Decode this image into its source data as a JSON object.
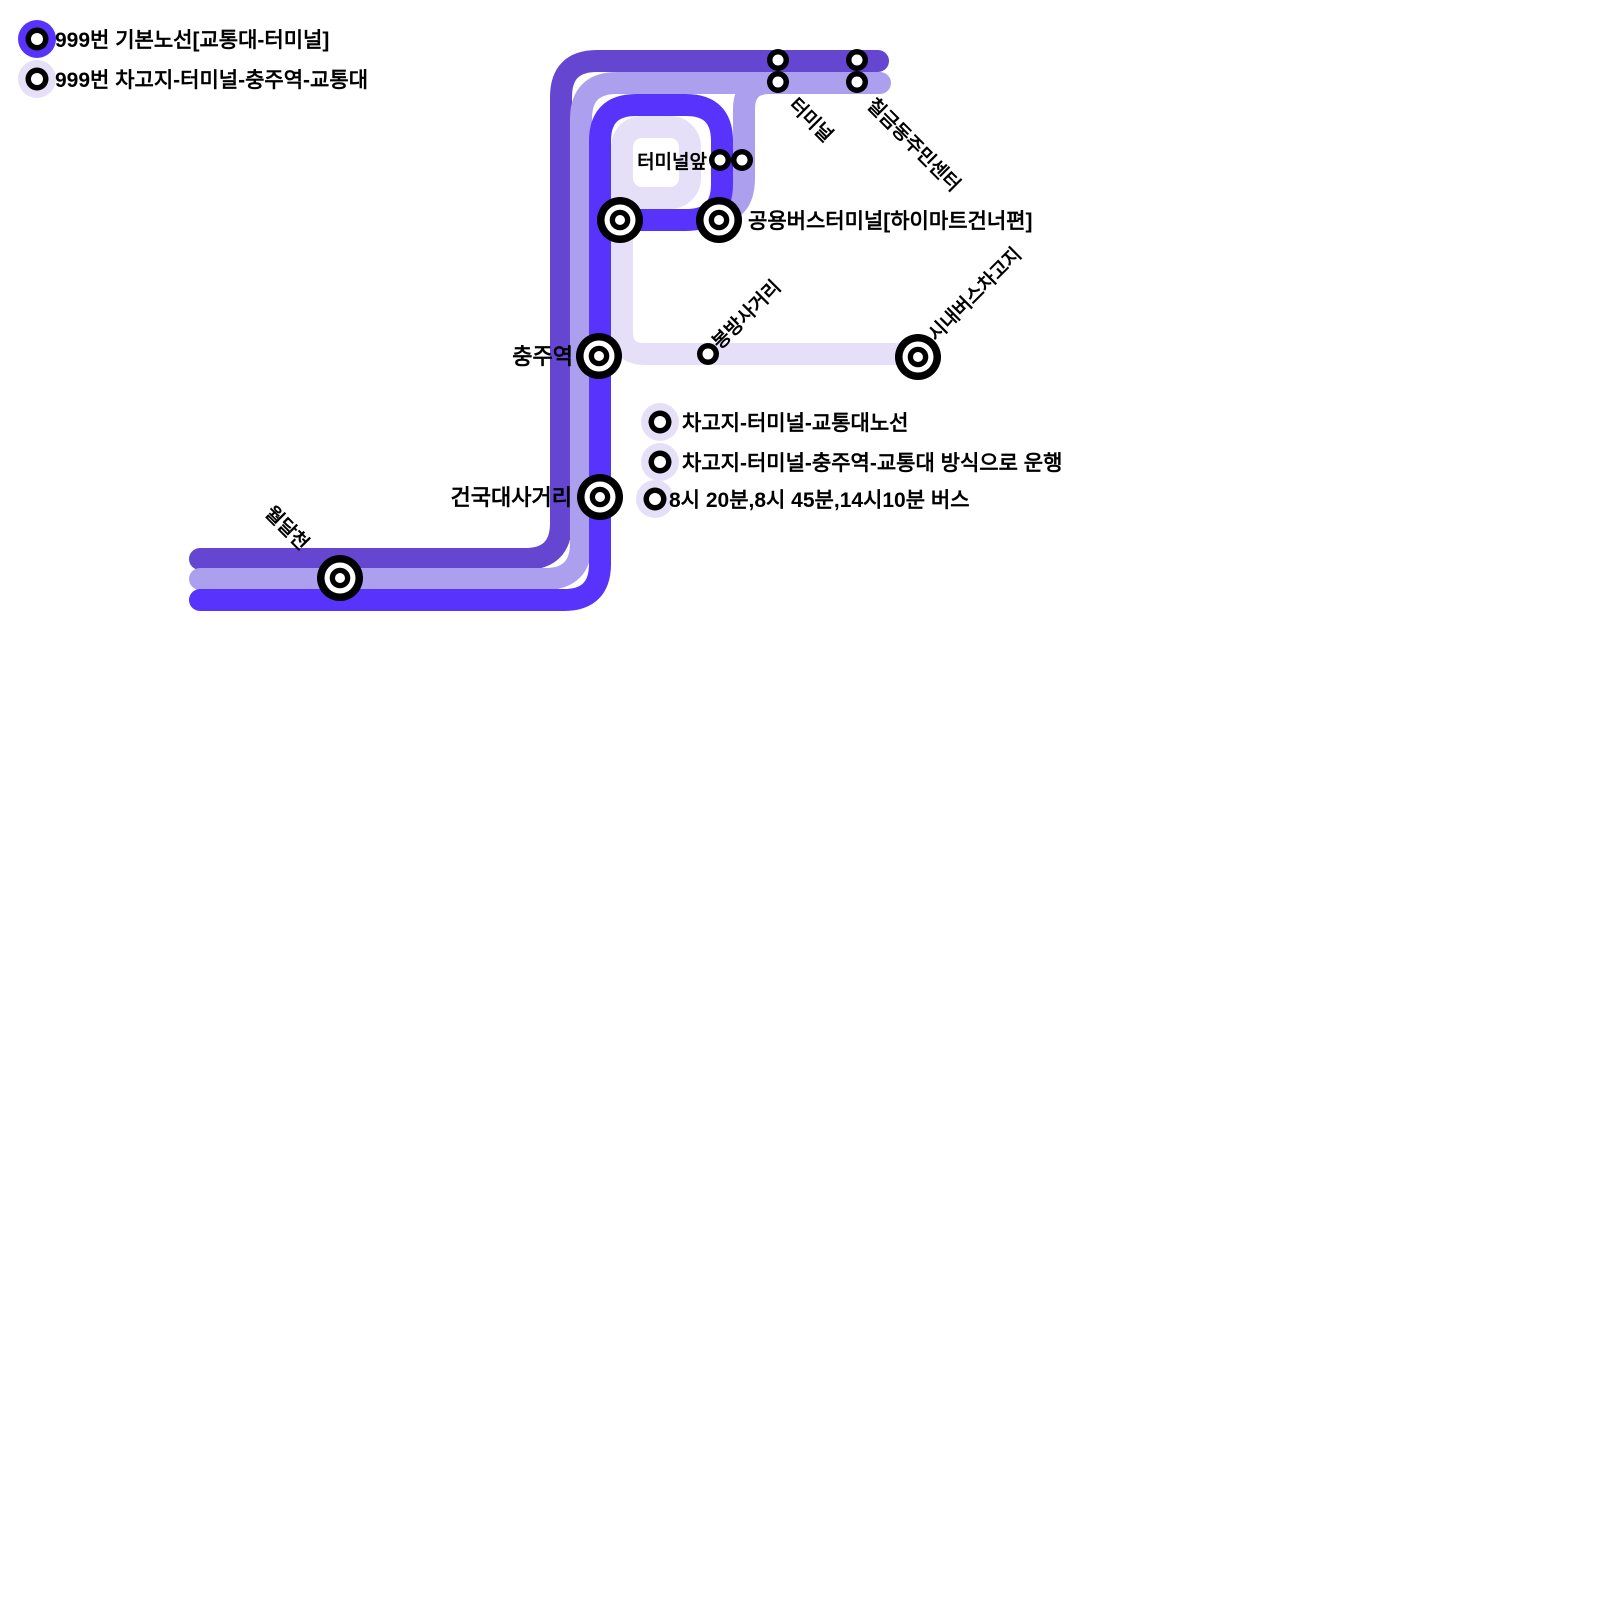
{
  "map_title": "999번 버스 노선도",
  "colors": {
    "route_basic": "#5733fb",
    "route_dark": "#6446d0",
    "route_light": "#aca0ee",
    "route_pale": "#e5e0f8",
    "marker": "#000000",
    "text": "#000000",
    "background": "#ffffff"
  },
  "legend": {
    "items": [
      {
        "label": "999번 기본노선[교통대-터미널]",
        "color": "#5733fb"
      },
      {
        "label": "999번 차고지-터미널-충주역-교통대",
        "color": "#e5e0f8"
      }
    ]
  },
  "notes": {
    "items": [
      {
        "label": "차고지-터미널-교통대노선"
      },
      {
        "label": "차고지-터미널-충주역-교통대 방식으로 운행"
      },
      {
        "label": "8시 20분,8시 45분,14시10분 버스"
      }
    ]
  },
  "stations": {
    "terminal_front": "터미널앞",
    "terminal": "터미널",
    "chilgeumdong_center": "칠금동주민센터",
    "public_bus_terminal": "공용버스터미널[하이마트건너편]",
    "chungju_station": "충주역",
    "bongbang_crossroads": "봉방사거리",
    "city_bus_garage": "시내버스차고지",
    "konkuk_crossroads": "건국대사거리",
    "woldalcheon": "월달천"
  }
}
